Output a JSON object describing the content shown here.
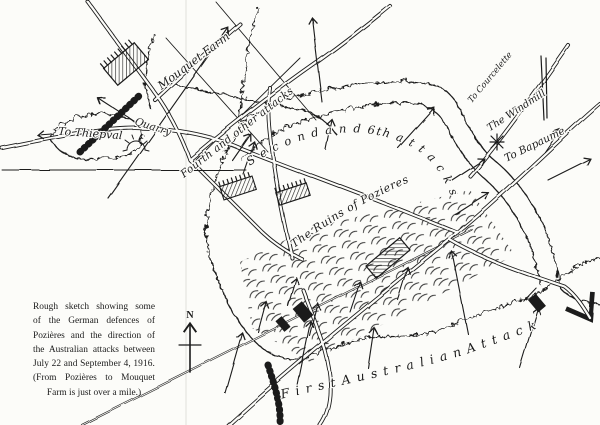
{
  "map": {
    "title": "Sketch map of Pozières defences and Australian attacks",
    "labels": {
      "mouquet_farm": "Mouquet Farm",
      "to_thiepval": "To Thiepval",
      "quarry": "Quarry",
      "fourth_attacks": "Fourth and other attacks",
      "second_attacks": "S e c o n d   a n d   6th  a t t a c k s",
      "ruins": "The Ruins of Pozieres",
      "to_courcelette": "To Courcelette",
      "windmill": "The Windmill",
      "to_bapaume": "To Bapaume .",
      "first_attack": "F i r s t   A u s t r a l i a n   A t t a c k",
      "north": "N"
    },
    "caption": {
      "lines": [
        "Rough sketch showing some",
        "of the German defences of",
        "Pozières and the direction of",
        "the Australian attacks between",
        "July 22 and September 4, 1916.",
        "(From Pozières to Mouquet",
        "Farm is just over a mile.)"
      ]
    },
    "colors": {
      "ink": "#1b1b1b",
      "paper": "#fcfcf9"
    }
  }
}
